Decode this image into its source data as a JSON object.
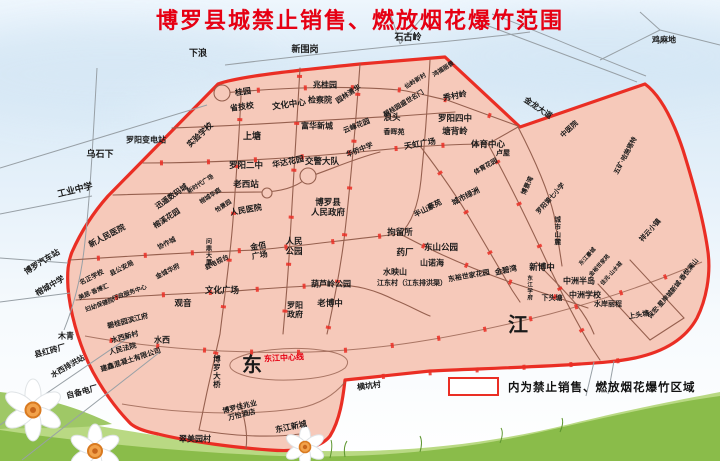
{
  "title": "博罗县城禁止销售、燃放烟花爆竹范围",
  "legend": {
    "text": "内为禁止销售、燃放烟花爆竹区域"
  },
  "colors": {
    "title_red": "#e60013",
    "zone_fill": "#f6c9ba",
    "zone_border": "#ea2e24",
    "road_brown": "#96604f",
    "outside_road_gray": "#98a0a6",
    "river_label_red": "#e60013",
    "grass_green": "#8abc4a",
    "sky_blue": "#d8e9f6"
  },
  "map": {
    "labels": [
      {
        "t": "下浪",
        "x": 198,
        "y": 53,
        "r": 0,
        "s": 9
      },
      {
        "t": "新围岗",
        "x": 305,
        "y": 49,
        "r": 0,
        "s": 9
      },
      {
        "t": "石古岭",
        "x": 408,
        "y": 37,
        "r": 0,
        "s": 9
      },
      {
        "t": "鸡麻地",
        "x": 664,
        "y": 40,
        "r": 0,
        "s": 8
      },
      {
        "t": "乌石下",
        "x": 100,
        "y": 154,
        "r": 0,
        "s": 9
      },
      {
        "t": "罗阳变电站",
        "x": 146,
        "y": 140,
        "r": 0,
        "s": 8
      },
      {
        "t": "工业中学",
        "x": 75,
        "y": 190,
        "r": -14,
        "s": 9
      },
      {
        "t": "博罗汽车站",
        "x": 42,
        "y": 262,
        "r": -32,
        "s": 8
      },
      {
        "t": "榕城中学",
        "x": 50,
        "y": 286,
        "r": -30,
        "s": 8
      },
      {
        "t": "县红砖厂",
        "x": 50,
        "y": 351,
        "r": -15,
        "s": 8
      },
      {
        "t": "水西排洪站",
        "x": 68,
        "y": 367,
        "r": -30,
        "s": 7.5
      },
      {
        "t": "自备电厂",
        "x": 82,
        "y": 392,
        "r": -15,
        "s": 8
      },
      {
        "t": "木青",
        "x": 66,
        "y": 336,
        "r": 0,
        "s": 8
      },
      {
        "t": "翠美园村",
        "x": 195,
        "y": 439,
        "r": 0,
        "s": 8
      },
      {
        "t": "横坑村",
        "x": 369,
        "y": 386,
        "r": -8,
        "s": 8
      },
      {
        "t": "实验学校",
        "x": 200,
        "y": 135,
        "r": -43,
        "s": 8
      },
      {
        "t": "省技校",
        "x": 242,
        "y": 107,
        "r": -8,
        "s": 8
      },
      {
        "t": "桂园",
        "x": 243,
        "y": 92,
        "r": -8,
        "s": 8
      },
      {
        "t": "文化中心",
        "x": 289,
        "y": 105,
        "r": -8,
        "s": 8.5
      },
      {
        "t": "兆桂园",
        "x": 325,
        "y": 85,
        "r": 0,
        "s": 8
      },
      {
        "t": "检察院",
        "x": 320,
        "y": 100,
        "r": 0,
        "s": 8
      },
      {
        "t": "园林清华",
        "x": 349,
        "y": 95,
        "r": -33,
        "s": 7
      },
      {
        "t": "碧桂园盛世名门",
        "x": 404,
        "y": 104,
        "r": -31,
        "s": 6.5
      },
      {
        "t": "浪头",
        "x": 392,
        "y": 118,
        "r": 0,
        "s": 8.5
      },
      {
        "t": "秀村岭",
        "x": 455,
        "y": 96,
        "r": -10,
        "s": 8
      },
      {
        "t": "仙岭新村",
        "x": 416,
        "y": 82,
        "r": -32,
        "s": 6
      },
      {
        "t": "鸿福丽景",
        "x": 444,
        "y": 70,
        "r": -32,
        "s": 6
      },
      {
        "t": "罗阳四中",
        "x": 455,
        "y": 119,
        "r": 0,
        "s": 8.5
      },
      {
        "t": "塘背岭",
        "x": 455,
        "y": 132,
        "r": 0,
        "s": 8.5
      },
      {
        "t": "金龙大道",
        "x": 538,
        "y": 108,
        "r": 34,
        "s": 8
      },
      {
        "t": "中医院",
        "x": 570,
        "y": 130,
        "r": -43,
        "s": 7
      },
      {
        "t": "五矿·哈施塔特",
        "x": 626,
        "y": 156,
        "r": -62,
        "s": 6.5
      },
      {
        "t": "上塘",
        "x": 252,
        "y": 136,
        "r": 0,
        "s": 9
      },
      {
        "t": "富华新城",
        "x": 317,
        "y": 126,
        "r": 0,
        "s": 8
      },
      {
        "t": "云峰花园",
        "x": 357,
        "y": 127,
        "r": -22,
        "s": 7
      },
      {
        "t": "华侨中学",
        "x": 360,
        "y": 151,
        "r": -22,
        "s": 7
      },
      {
        "t": "香晖苑",
        "x": 394,
        "y": 133,
        "r": 0,
        "s": 7
      },
      {
        "t": "罗阳二中",
        "x": 246,
        "y": 166,
        "r": 0,
        "s": 8.5
      },
      {
        "t": "华达花园",
        "x": 288,
        "y": 162,
        "r": -12,
        "s": 8
      },
      {
        "t": "交警大队",
        "x": 322,
        "y": 162,
        "r": 0,
        "s": 8.5
      },
      {
        "t": "天虹广场",
        "x": 420,
        "y": 144,
        "r": -10,
        "s": 8
      },
      {
        "t": "体育中心",
        "x": 488,
        "y": 145,
        "r": 0,
        "s": 8.5
      },
      {
        "t": "卢屋",
        "x": 503,
        "y": 154,
        "r": 0,
        "s": 7
      },
      {
        "t": "体育花园",
        "x": 486,
        "y": 167,
        "r": -30,
        "s": 6.5
      },
      {
        "t": "博景湾",
        "x": 528,
        "y": 186,
        "r": -65,
        "s": 6.5
      },
      {
        "t": "罗阳第七小学",
        "x": 551,
        "y": 199,
        "r": -48,
        "s": 6.5
      },
      {
        "t": "城市山麓",
        "x": 556,
        "y": 231,
        "r": 0,
        "s": 6.5,
        "c": "vert"
      },
      {
        "t": "祥云小镇",
        "x": 651,
        "y": 231,
        "r": -48,
        "s": 7
      },
      {
        "t": "新城·香悦澜山",
        "x": 685,
        "y": 276,
        "r": -52,
        "s": 6.5
      },
      {
        "t": "保宏·星岸城",
        "x": 661,
        "y": 305,
        "r": -48,
        "s": 6.5
      },
      {
        "t": "老西站",
        "x": 246,
        "y": 185,
        "r": 0,
        "s": 8.5
      },
      {
        "t": "人民医院",
        "x": 246,
        "y": 210,
        "r": -10,
        "s": 8
      },
      {
        "t": "博罗县\n人民政府",
        "x": 328,
        "y": 208,
        "r": 0,
        "s": 8.5
      },
      {
        "t": "人民\n公园",
        "x": 294,
        "y": 247,
        "r": 0,
        "s": 8.5
      },
      {
        "t": "金佰\n广场",
        "x": 259,
        "y": 251,
        "r": -10,
        "s": 8
      },
      {
        "t": "拘留所",
        "x": 400,
        "y": 233,
        "r": 0,
        "s": 8.5
      },
      {
        "t": "药厂",
        "x": 405,
        "y": 253,
        "r": 0,
        "s": 8.5
      },
      {
        "t": "东山公园",
        "x": 441,
        "y": 248,
        "r": 0,
        "s": 8.5
      },
      {
        "t": "山诺海",
        "x": 432,
        "y": 263,
        "r": 0,
        "s": 8
      },
      {
        "t": "水映山",
        "x": 395,
        "y": 272,
        "r": 0,
        "s": 8
      },
      {
        "t": "江东村（江东排洪渠）",
        "x": 412,
        "y": 284,
        "r": 0,
        "s": 7
      },
      {
        "t": "东裕世家花园",
        "x": 469,
        "y": 277,
        "r": -10,
        "s": 7
      },
      {
        "t": "金碧湾",
        "x": 506,
        "y": 271,
        "r": -12,
        "s": 7.5
      },
      {
        "t": "新博中",
        "x": 542,
        "y": 268,
        "r": 0,
        "s": 8.5
      },
      {
        "t": "中洲半岛",
        "x": 579,
        "y": 281,
        "r": 0,
        "s": 8
      },
      {
        "t": "中洲学校",
        "x": 585,
        "y": 295,
        "r": 0,
        "s": 8
      },
      {
        "t": "水岸丽程",
        "x": 608,
        "y": 305,
        "r": 0,
        "s": 7
      },
      {
        "t": "下头塘",
        "x": 552,
        "y": 299,
        "r": 0,
        "s": 7
      },
      {
        "t": "上头塘",
        "x": 639,
        "y": 316,
        "r": -10,
        "s": 7
      },
      {
        "t": "东江学府",
        "x": 529,
        "y": 288,
        "r": 0,
        "s": 5.5,
        "c": "vert"
      },
      {
        "t": "东江豪城",
        "x": 588,
        "y": 257,
        "r": -48,
        "s": 5.5
      },
      {
        "t": "金裕世家苑",
        "x": 600,
        "y": 266,
        "r": -48,
        "s": 5.5
      },
      {
        "t": "佳兆·山水城",
        "x": 612,
        "y": 274,
        "r": -48,
        "s": 5.5
      },
      {
        "t": "半山豪苑",
        "x": 428,
        "y": 209,
        "r": -27,
        "s": 7.5
      },
      {
        "t": "城市绿洲",
        "x": 466,
        "y": 197,
        "r": -27,
        "s": 7.5
      },
      {
        "t": "迅遥数码城",
        "x": 172,
        "y": 197,
        "r": -35,
        "s": 7.5
      },
      {
        "t": "榕溪花园",
        "x": 167,
        "y": 219,
        "r": -33,
        "s": 7.5
      },
      {
        "t": "新时代广场",
        "x": 201,
        "y": 185,
        "r": -33,
        "s": 6
      },
      {
        "t": "榕城华庭",
        "x": 211,
        "y": 197,
        "r": -33,
        "s": 6
      },
      {
        "t": "怡景园",
        "x": 224,
        "y": 207,
        "r": -33,
        "s": 6
      },
      {
        "t": "新人民医院",
        "x": 107,
        "y": 236,
        "r": -28,
        "s": 8
      },
      {
        "t": "协作城",
        "x": 167,
        "y": 244,
        "r": -27,
        "s": 6.5
      },
      {
        "t": "问鼎大厦",
        "x": 207,
        "y": 252,
        "r": 0,
        "s": 6,
        "c": "vert"
      },
      {
        "t": "县电视台",
        "x": 217,
        "y": 263,
        "r": -27,
        "s": 6.5
      },
      {
        "t": "金城华府",
        "x": 168,
        "y": 272,
        "r": -27,
        "s": 6.5
      },
      {
        "t": "县公安局",
        "x": 122,
        "y": 269,
        "r": -27,
        "s": 6.5
      },
      {
        "t": "名正学校",
        "x": 92,
        "y": 278,
        "r": -27,
        "s": 6.5
      },
      {
        "t": "美居·香博汇",
        "x": 94,
        "y": 293,
        "r": -23,
        "s": 6
      },
      {
        "t": "行政服务中心",
        "x": 130,
        "y": 294,
        "r": -20,
        "s": 6
      },
      {
        "t": "妇幼保健院",
        "x": 100,
        "y": 306,
        "r": -20,
        "s": 6
      },
      {
        "t": "文化广场",
        "x": 222,
        "y": 291,
        "r": 0,
        "s": 8.5
      },
      {
        "t": "观音",
        "x": 183,
        "y": 304,
        "r": 0,
        "s": 8.5
      },
      {
        "t": "碧桂园滨江府",
        "x": 128,
        "y": 322,
        "r": -15,
        "s": 7
      },
      {
        "t": "水西新村",
        "x": 125,
        "y": 338,
        "r": -15,
        "s": 7
      },
      {
        "t": "人民法院",
        "x": 123,
        "y": 350,
        "r": -15,
        "s": 7
      },
      {
        "t": "建鑫混凝土有限公司",
        "x": 131,
        "y": 361,
        "r": -18,
        "s": 7
      },
      {
        "t": "水西",
        "x": 162,
        "y": 340,
        "r": 0,
        "s": 8
      },
      {
        "t": "葫芦岭公园",
        "x": 331,
        "y": 284,
        "r": 0,
        "s": 8
      },
      {
        "t": "老博中",
        "x": 330,
        "y": 304,
        "r": 0,
        "s": 8.5
      },
      {
        "t": "罗阳\n政府",
        "x": 295,
        "y": 310,
        "r": 0,
        "s": 8
      },
      {
        "t": "博罗大桥",
        "x": 216,
        "y": 372,
        "r": 0,
        "s": 7.5,
        "c": "vert"
      },
      {
        "t": "博罗佳兆业\n万怡酒店",
        "x": 241,
        "y": 412,
        "r": -14,
        "s": 7
      },
      {
        "t": "东江新城",
        "x": 291,
        "y": 427,
        "r": -12,
        "s": 8
      },
      {
        "t": "东",
        "x": 253,
        "y": 366,
        "r": 0,
        "s": 20,
        "c": "big"
      },
      {
        "t": "江",
        "x": 519,
        "y": 326,
        "r": 0,
        "s": 20,
        "c": "big"
      },
      {
        "t": "东江中心线",
        "x": 284,
        "y": 358,
        "r": -3,
        "s": 8,
        "c": "red"
      }
    ]
  }
}
